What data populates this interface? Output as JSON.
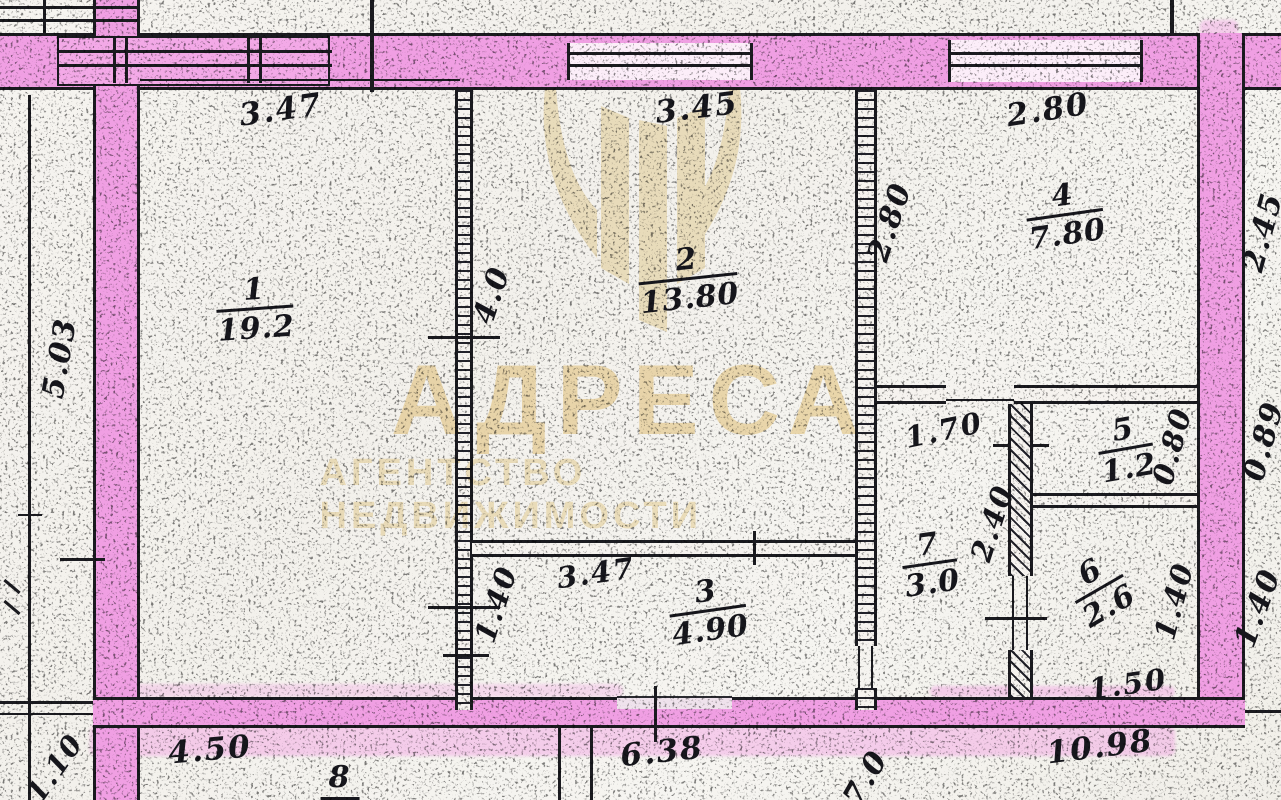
{
  "document": {
    "kind": "scanned apartment floor plan",
    "language": "ru"
  },
  "colors": {
    "highlighter_pink": "#f09fe3",
    "ink": "#1b1b20",
    "paper": "#f5f3ef",
    "watermark_beige": "#f2ddae"
  },
  "watermark": {
    "title": "АДРЕСА",
    "subtitle": "АГЕНТСТВО НЕДВИЖИМОСТИ",
    "logo": "tulip-watermark-logo"
  },
  "rooms": [
    {
      "number": "1",
      "area": "19.2",
      "x": 255,
      "y": 310,
      "rot": -4
    },
    {
      "number": "2",
      "area": "13.80",
      "x": 688,
      "y": 280,
      "rot": -6
    },
    {
      "number": "3",
      "area": "4.90",
      "x": 708,
      "y": 612,
      "rot": -8
    },
    {
      "number": "4",
      "area": "7.80",
      "x": 1065,
      "y": 216,
      "rot": -8
    },
    {
      "number": "5",
      "area": "1.2",
      "x": 1126,
      "y": 450,
      "rot": -10
    },
    {
      "number": "7",
      "area": "3.0",
      "x": 930,
      "y": 565,
      "rot": -8
    },
    {
      "number": "6",
      "area": "2.6",
      "x": 1100,
      "y": 590,
      "rot": -30
    }
  ],
  "dimensions": [
    {
      "text": "3.47",
      "x": 281,
      "y": 110,
      "rot": -8,
      "size": 31
    },
    {
      "text": "3.45",
      "x": 697,
      "y": 108,
      "rot": -7,
      "size": 31
    },
    {
      "text": "2.80",
      "x": 1048,
      "y": 110,
      "rot": -9,
      "size": 31
    },
    {
      "text": "5.03",
      "x": 60,
      "y": 358,
      "rot": -80,
      "size": 30
    },
    {
      "text": "4.0",
      "x": 492,
      "y": 295,
      "rot": -72,
      "size": 30
    },
    {
      "text": "2.80",
      "x": 890,
      "y": 222,
      "rot": -72,
      "size": 30
    },
    {
      "text": "1.70",
      "x": 944,
      "y": 430,
      "rot": -12,
      "size": 29
    },
    {
      "text": "0.80",
      "x": 1172,
      "y": 446,
      "rot": -75,
      "size": 29
    },
    {
      "text": "2.40",
      "x": 992,
      "y": 523,
      "rot": -72,
      "size": 29
    },
    {
      "text": "3.47",
      "x": 596,
      "y": 573,
      "rot": -8,
      "size": 29
    },
    {
      "text": "1.40",
      "x": 496,
      "y": 604,
      "rot": -72,
      "size": 29
    },
    {
      "text": "1.40",
      "x": 1174,
      "y": 601,
      "rot": -75,
      "size": 29
    },
    {
      "text": "1.50",
      "x": 1128,
      "y": 684,
      "rot": -8,
      "size": 29
    },
    {
      "text": "2.45",
      "x": 1263,
      "y": 232,
      "rot": -75,
      "size": 30
    },
    {
      "text": "0.89",
      "x": 1264,
      "y": 441,
      "rot": -75,
      "size": 30
    },
    {
      "text": "1.40",
      "x": 1258,
      "y": 608,
      "rot": -70,
      "size": 30
    },
    {
      "text": "4.50",
      "x": 210,
      "y": 750,
      "rot": -5,
      "size": 31
    },
    {
      "text": "1.10",
      "x": 55,
      "y": 768,
      "rot": -55,
      "size": 28
    },
    {
      "text": "8",
      "x": 340,
      "y": 780,
      "rot": 0,
      "size": 30,
      "underline": true
    },
    {
      "text": "6.38",
      "x": 662,
      "y": 752,
      "rot": -6,
      "size": 31
    },
    {
      "text": "7.0",
      "x": 866,
      "y": 778,
      "rot": -60,
      "size": 30
    },
    {
      "text": "10.98",
      "x": 1100,
      "y": 747,
      "rot": -7,
      "size": 31
    }
  ]
}
